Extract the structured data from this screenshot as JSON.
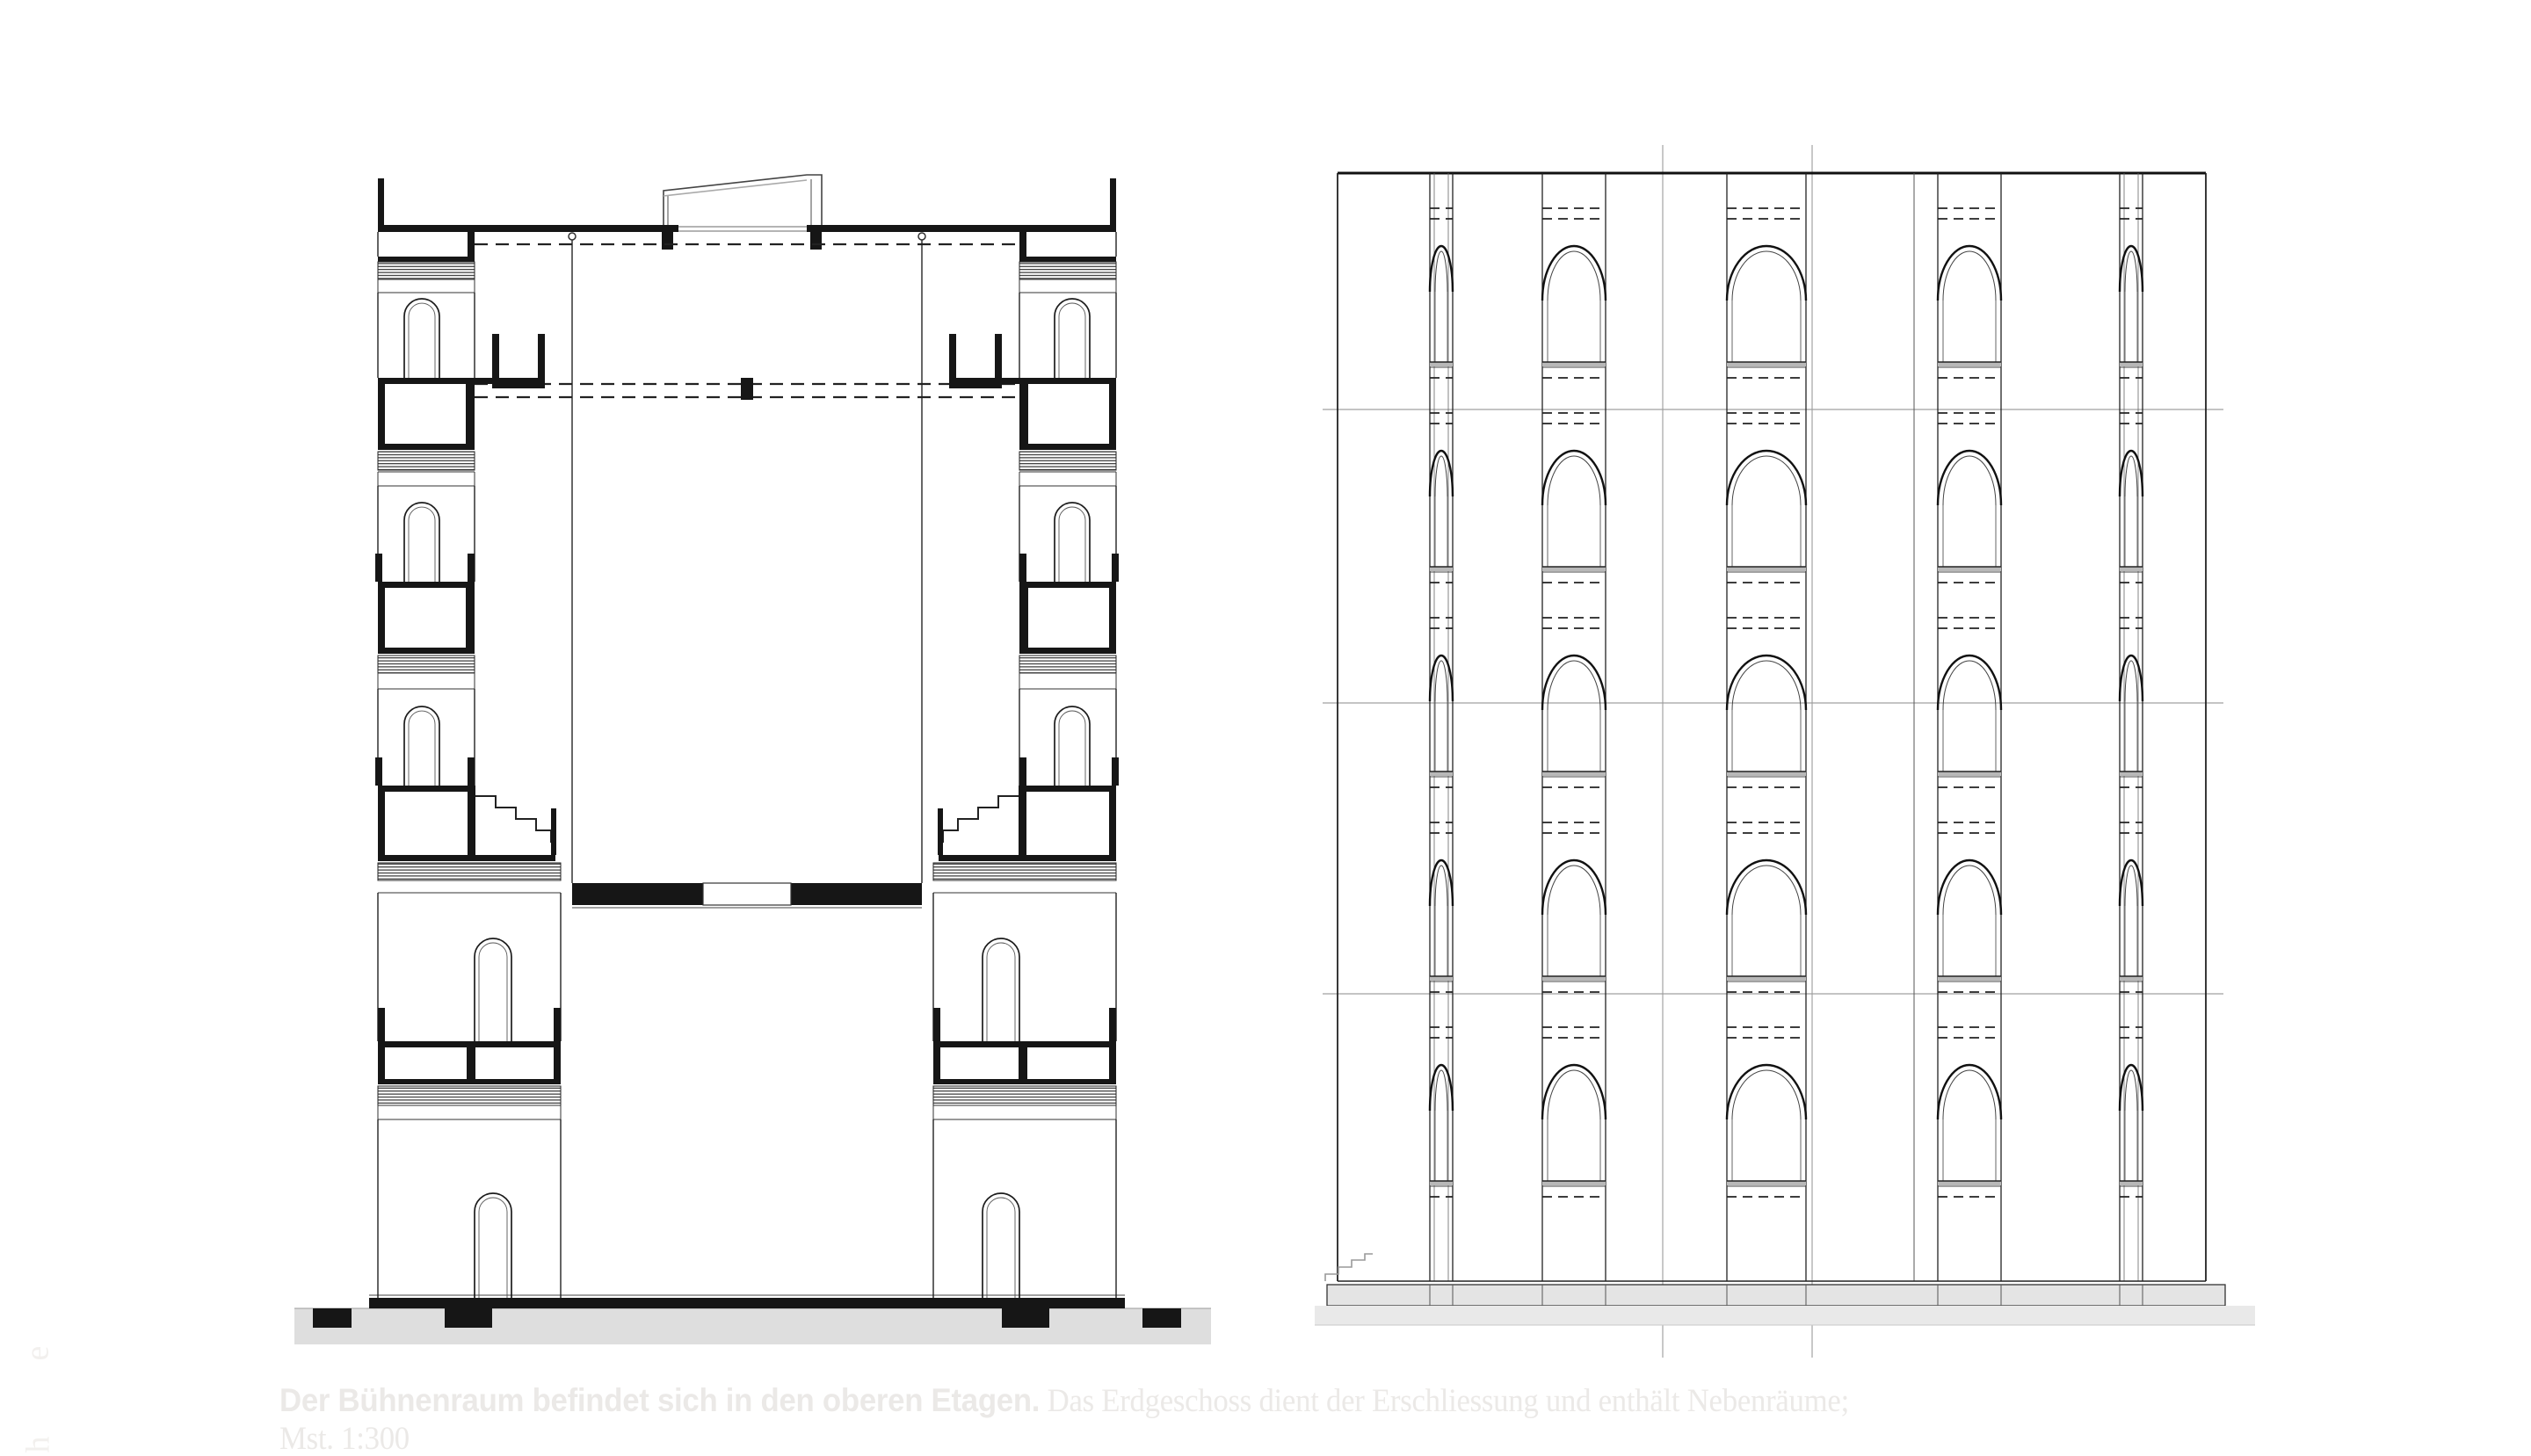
{
  "page": {
    "background": "#ffffff",
    "ink": "#161616",
    "ground_gray": "#dedede",
    "plinth_gray": "#e6e6e6",
    "faint_text_color": "#ebe9e7",
    "edge_text_color": "#f2f0ee"
  },
  "caption": {
    "lead": "Der Bühnenraum befindet sich in den oberen Etagen.",
    "body": " Das Erdgeschoss dient der Erschliessung und enthält Nebenräume;",
    "scale_note": "Mst. 1:300"
  },
  "edge_text": {
    "letters": [
      "e",
      "h"
    ]
  },
  "figures": {
    "section": {
      "label": "building-cross-section",
      "storey_modules": 3,
      "has_stage_void": true,
      "has_roof_monitor": true
    },
    "elevation": {
      "label": "arched-facade-elevation",
      "arch_rows": 5,
      "window_bays": 5,
      "datum_lines": 3
    }
  }
}
